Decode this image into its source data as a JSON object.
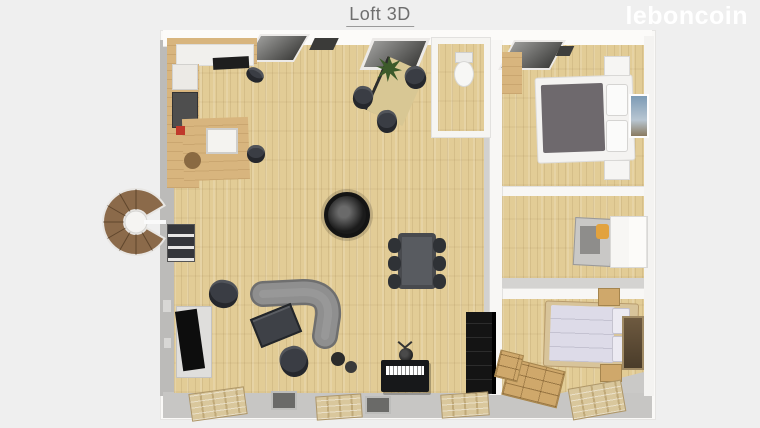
{
  "header": {
    "title": "Loft 3D"
  },
  "brand": {
    "logo": "leboncoin"
  },
  "colors": {
    "background": "#efefef",
    "title_text": "#6e6e6e",
    "logo_text": "#ffffff",
    "wall_white": "#f8f7f5",
    "wall_gray": "#c2c1bf",
    "floor_wood": "#e2cc96",
    "kitchen_wood": "#d8b57e",
    "sofa_gray": "#8f8f8f",
    "chair_dark": "#3a3d44",
    "bed_duvet_gray": "#6e696d",
    "bed_duvet_lavender": "#dddbe8",
    "accent_orange": "#e2a23e"
  }
}
